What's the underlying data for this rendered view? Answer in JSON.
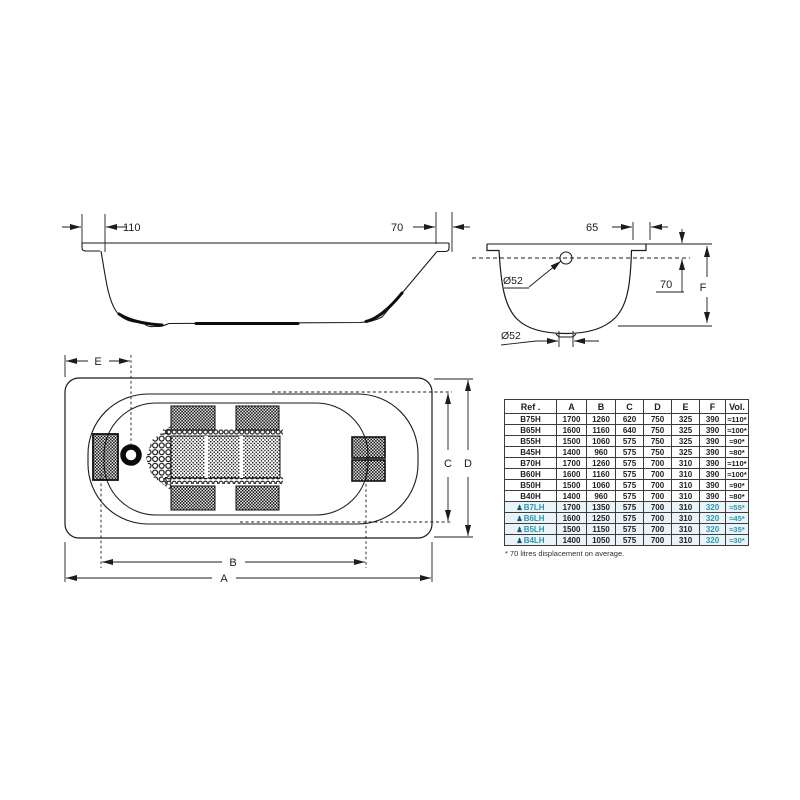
{
  "accent": {
    "teal": "#2e97ae",
    "line": "#1c1c1c"
  },
  "side_view": {
    "left_dim": "110",
    "right_dim": "70"
  },
  "cross_section": {
    "top_dim": "65",
    "overflow_dia": "Ø52",
    "rim_to_overflow": "70",
    "depth_label": "F",
    "drain_dia": "Ø52"
  },
  "top_view": {
    "drain_offset": "E",
    "width_inner": "C",
    "width_total": "D",
    "length_bottom": "B",
    "length_total": "A"
  },
  "table": {
    "headers": [
      "Ref .",
      "A",
      "B",
      "C",
      "D",
      "E",
      "F",
      "Vol."
    ],
    "row_icon": "♟",
    "rows": [
      {
        "ref": "B75H",
        "a": "1700",
        "b": "1260",
        "c": "620",
        "d": "750",
        "e": "325",
        "f": "390",
        "vol": "≈110*",
        "highlight": false
      },
      {
        "ref": "B65H",
        "a": "1600",
        "b": "1160",
        "c": "640",
        "d": "750",
        "e": "325",
        "f": "390",
        "vol": "≈100*",
        "highlight": false
      },
      {
        "ref": "B55H",
        "a": "1500",
        "b": "1060",
        "c": "575",
        "d": "750",
        "e": "325",
        "f": "390",
        "vol": "≈90*",
        "highlight": false
      },
      {
        "ref": "B45H",
        "a": "1400",
        "b": "960",
        "c": "575",
        "d": "750",
        "e": "325",
        "f": "390",
        "vol": "≈80*",
        "highlight": false
      },
      {
        "ref": "B70H",
        "a": "1700",
        "b": "1260",
        "c": "575",
        "d": "700",
        "e": "310",
        "f": "390",
        "vol": "≈110*",
        "highlight": false
      },
      {
        "ref": "B60H",
        "a": "1600",
        "b": "1160",
        "c": "575",
        "d": "700",
        "e": "310",
        "f": "390",
        "vol": "≈100*",
        "highlight": false
      },
      {
        "ref": "B50H",
        "a": "1500",
        "b": "1060",
        "c": "575",
        "d": "700",
        "e": "310",
        "f": "390",
        "vol": "≈90*",
        "highlight": false
      },
      {
        "ref": "B40H",
        "a": "1400",
        "b": "960",
        "c": "575",
        "d": "700",
        "e": "310",
        "f": "390",
        "vol": "≈80*",
        "highlight": false
      },
      {
        "ref": "B7LH",
        "a": "1700",
        "b": "1350",
        "c": "575",
        "d": "700",
        "e": "310",
        "f": "320",
        "vol": "≈55*",
        "highlight": true
      },
      {
        "ref": "B6LH",
        "a": "1600",
        "b": "1250",
        "c": "575",
        "d": "700",
        "e": "310",
        "f": "320",
        "vol": "≈45*",
        "highlight": true
      },
      {
        "ref": "B5LH",
        "a": "1500",
        "b": "1150",
        "c": "575",
        "d": "700",
        "e": "310",
        "f": "320",
        "vol": "≈35*",
        "highlight": true
      },
      {
        "ref": "B4LH",
        "a": "1400",
        "b": "1050",
        "c": "575",
        "d": "700",
        "e": "310",
        "f": "320",
        "vol": "≈30*",
        "highlight": true
      }
    ],
    "footnote": "* 70 litres displacement on average."
  }
}
